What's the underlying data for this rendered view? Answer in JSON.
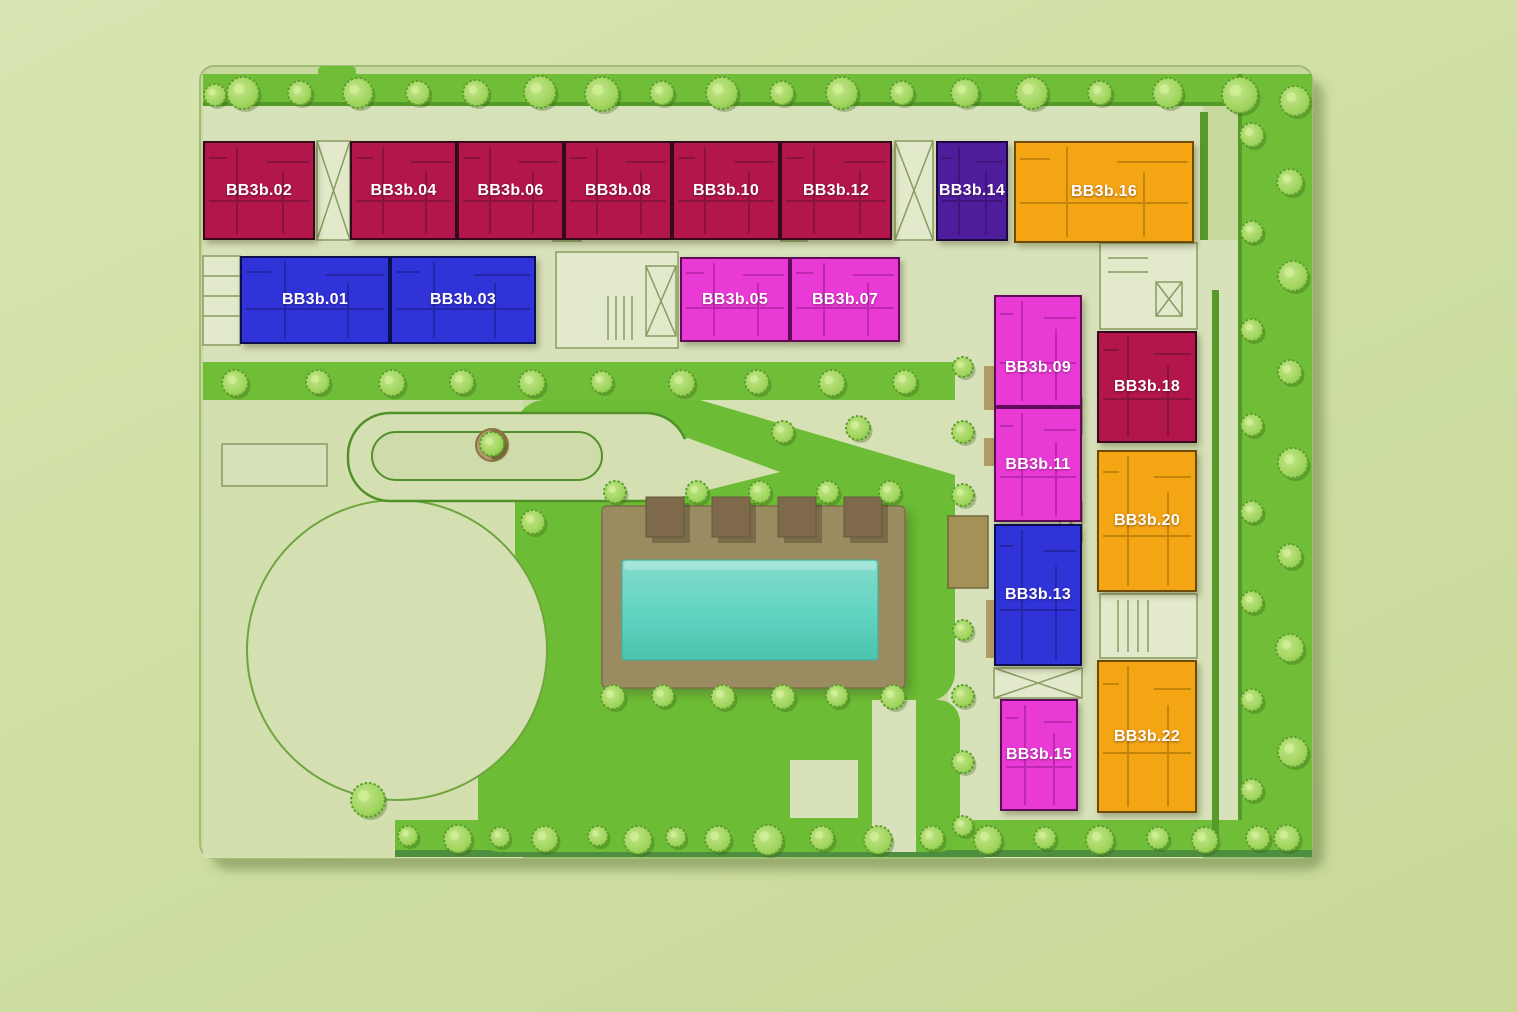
{
  "units": [
    {
      "id": "bb3b-02",
      "label": "BB3b.02",
      "color_key": "red"
    },
    {
      "id": "bb3b-04",
      "label": "BB3b.04",
      "color_key": "red"
    },
    {
      "id": "bb3b-06",
      "label": "BB3b.06",
      "color_key": "red"
    },
    {
      "id": "bb3b-08",
      "label": "BB3b.08",
      "color_key": "red"
    },
    {
      "id": "bb3b-10",
      "label": "BB3b.10",
      "color_key": "red"
    },
    {
      "id": "bb3b-12",
      "label": "BB3b.12",
      "color_key": "red"
    },
    {
      "id": "bb3b-14",
      "label": "BB3b.14",
      "color_key": "purple"
    },
    {
      "id": "bb3b-16",
      "label": "BB3b.16",
      "color_key": "orange"
    },
    {
      "id": "bb3b-01",
      "label": "BB3b.01",
      "color_key": "blue"
    },
    {
      "id": "bb3b-03",
      "label": "BB3b.03",
      "color_key": "blue"
    },
    {
      "id": "bb3b-05",
      "label": "BB3b.05",
      "color_key": "magenta"
    },
    {
      "id": "bb3b-07",
      "label": "BB3b.07",
      "color_key": "magenta"
    },
    {
      "id": "bb3b-09",
      "label": "BB3b.09",
      "color_key": "magenta"
    },
    {
      "id": "bb3b-11",
      "label": "BB3b.11",
      "color_key": "magenta"
    },
    {
      "id": "bb3b-13",
      "label": "BB3b.13",
      "color_key": "blue"
    },
    {
      "id": "bb3b-15",
      "label": "BB3b.15",
      "color_key": "magenta"
    },
    {
      "id": "bb3b-18",
      "label": "BB3b.18",
      "color_key": "red"
    },
    {
      "id": "bb3b-20",
      "label": "BB3b.20",
      "color_key": "orange"
    },
    {
      "id": "bb3b-22",
      "label": "BB3b.22",
      "color_key": "orange"
    }
  ],
  "palette": {
    "red": "#b2164a",
    "blue": "#2f33d8",
    "magenta": "#e93ad6",
    "purple": "#4e1d9c",
    "orange": "#f3a513",
    "background": "#cfdfa4",
    "site": "#c8d99e",
    "hardscape": "#d8e2ba",
    "lawn": "#6cbd35",
    "lawn_strip": "#70bd38",
    "lawn_edge": "#549a28",
    "tree_foliage": "#9fd45c",
    "tree_outline": "#5d9e2c",
    "pool_water": "#5ed2c0",
    "pool_deck": "#9b8b60",
    "cabana": "#7e6a4b",
    "core": "#e3eacb",
    "core_line": "#8a9a63",
    "planter": "#b39b6d",
    "canopy": "#a39158"
  },
  "landscape": {
    "trees": [
      [
        215,
        95,
        11
      ],
      [
        243,
        93,
        16
      ],
      [
        300,
        93,
        12
      ],
      [
        358,
        93,
        15
      ],
      [
        418,
        93,
        12
      ],
      [
        476,
        93,
        13
      ],
      [
        540,
        92,
        16
      ],
      [
        602,
        94,
        17
      ],
      [
        662,
        93,
        12
      ],
      [
        722,
        93,
        16
      ],
      [
        782,
        93,
        12
      ],
      [
        842,
        93,
        16
      ],
      [
        902,
        93,
        12
      ],
      [
        965,
        93,
        14
      ],
      [
        1032,
        93,
        16
      ],
      [
        1100,
        93,
        12
      ],
      [
        1168,
        93,
        15
      ],
      [
        1240,
        95,
        18
      ],
      [
        1295,
        101,
        15
      ],
      [
        235,
        383,
        13
      ],
      [
        318,
        382,
        12
      ],
      [
        392,
        383,
        13
      ],
      [
        462,
        382,
        12
      ],
      [
        532,
        383,
        13
      ],
      [
        602,
        382,
        11
      ],
      [
        682,
        383,
        13
      ],
      [
        757,
        382,
        12
      ],
      [
        832,
        383,
        13
      ],
      [
        905,
        382,
        12
      ],
      [
        963,
        367,
        10
      ],
      [
        963,
        432,
        11
      ],
      [
        963,
        495,
        11
      ],
      [
        963,
        630,
        10
      ],
      [
        963,
        696,
        11
      ],
      [
        963,
        762,
        11
      ],
      [
        963,
        826,
        10
      ],
      [
        1252,
        135,
        12
      ],
      [
        1290,
        182,
        13
      ],
      [
        1252,
        232,
        11
      ],
      [
        1293,
        276,
        15
      ],
      [
        1252,
        330,
        11
      ],
      [
        1290,
        372,
        12
      ],
      [
        1252,
        425,
        11
      ],
      [
        1293,
        463,
        15
      ],
      [
        1252,
        512,
        11
      ],
      [
        1290,
        556,
        12
      ],
      [
        1252,
        602,
        11
      ],
      [
        1290,
        648,
        14
      ],
      [
        1252,
        700,
        11
      ],
      [
        1293,
        752,
        15
      ],
      [
        1252,
        790,
        11
      ],
      [
        1287,
        838,
        13
      ],
      [
        408,
        836,
        10
      ],
      [
        458,
        839,
        14
      ],
      [
        500,
        837,
        10
      ],
      [
        545,
        839,
        13
      ],
      [
        598,
        836,
        10
      ],
      [
        638,
        840,
        14
      ],
      [
        676,
        837,
        10
      ],
      [
        718,
        839,
        13
      ],
      [
        768,
        840,
        15
      ],
      [
        822,
        838,
        12
      ],
      [
        878,
        840,
        14
      ],
      [
        932,
        838,
        12
      ],
      [
        988,
        840,
        14
      ],
      [
        1045,
        838,
        11
      ],
      [
        1100,
        840,
        14
      ],
      [
        1158,
        838,
        11
      ],
      [
        1205,
        840,
        13
      ],
      [
        1258,
        838,
        12
      ],
      [
        615,
        492,
        11
      ],
      [
        697,
        492,
        11
      ],
      [
        760,
        492,
        11
      ],
      [
        828,
        492,
        11
      ],
      [
        890,
        492,
        11
      ],
      [
        613,
        697,
        12
      ],
      [
        663,
        696,
        11
      ],
      [
        723,
        697,
        12
      ],
      [
        783,
        697,
        12
      ],
      [
        837,
        696,
        11
      ],
      [
        893,
        697,
        12
      ],
      [
        533,
        522,
        12
      ],
      [
        783,
        432,
        11
      ],
      [
        858,
        428,
        12
      ],
      [
        492,
        444,
        12
      ],
      [
        368,
        800,
        17
      ]
    ]
  }
}
